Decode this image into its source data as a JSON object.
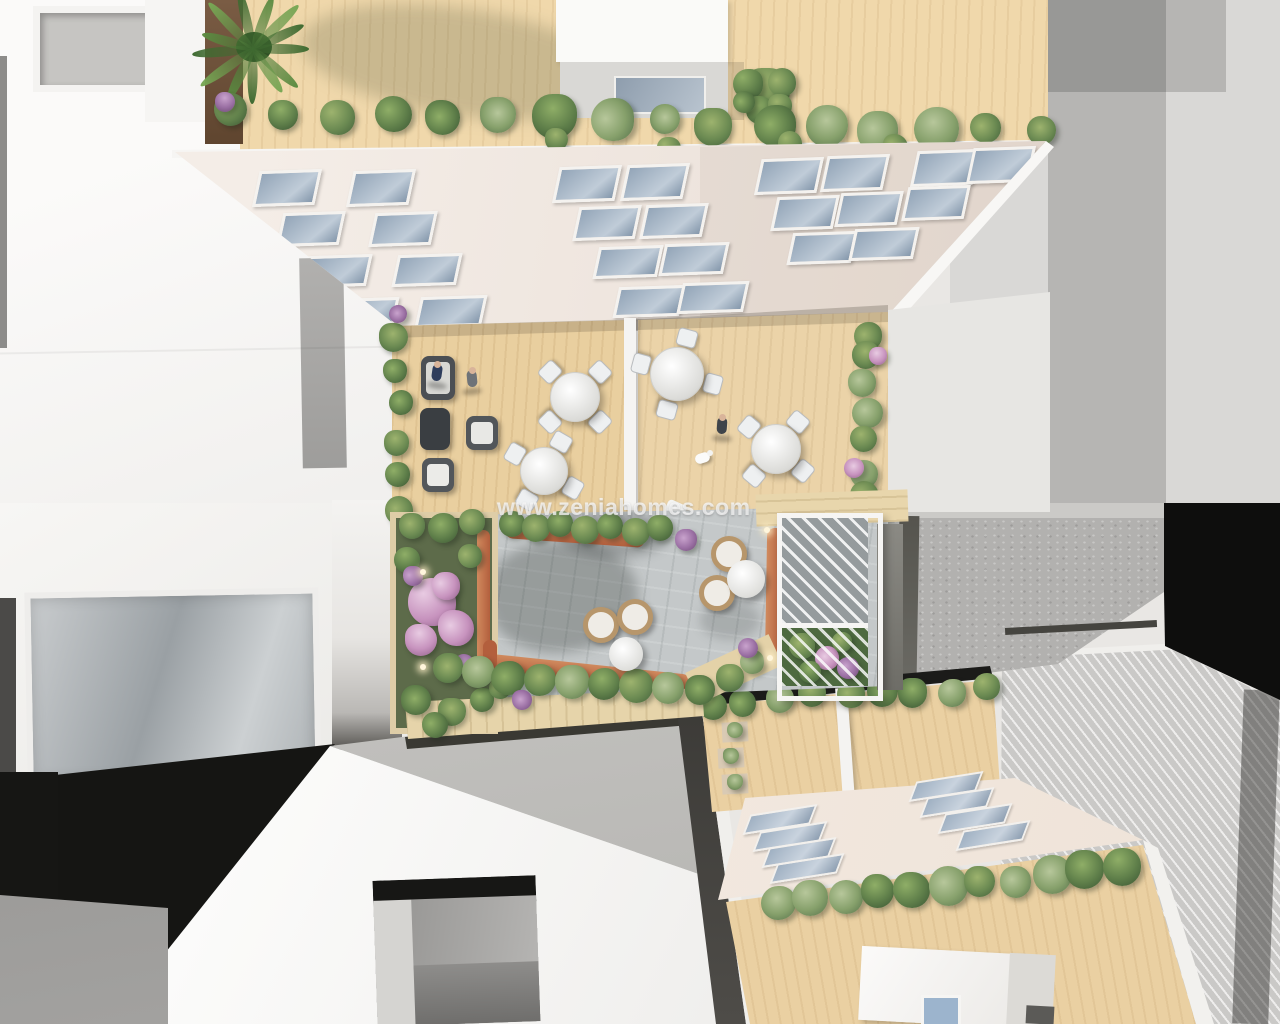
{
  "watermark": {
    "text": "www.zeniahomes.com"
  },
  "scene_description": "aerial top-down 3D render of residential buildings with roof terraces, courtyard garden, pergola and outdoor furniture",
  "palette": {
    "wood_deck": "#f0d8ab",
    "wood_deck_mid": "#e9cf9f",
    "wood_deck_low": "#ead0a2",
    "roof_white": "#f6f5f3",
    "roof_gray": "#d9d8d6",
    "concrete_gray": "#b2b1af",
    "paving_gray": "#c4c8c9",
    "facade_white": "#f3ece6",
    "window_glass": "#93a5b8",
    "glass_blue": "#9cb4cd",
    "shadow_dark": "#151513",
    "hedge_green_light": "#9db36e",
    "hedge_green_mid": "#6b8a52",
    "hedge_green_dark": "#42603a",
    "flower_pink": "#c793be",
    "flower_purple": "#9a6fa3",
    "terracotta": "#c06a48",
    "rattan": "#b7966b",
    "furniture_dark": "#4b4f54",
    "furniture_white": "#eef0f1"
  }
}
